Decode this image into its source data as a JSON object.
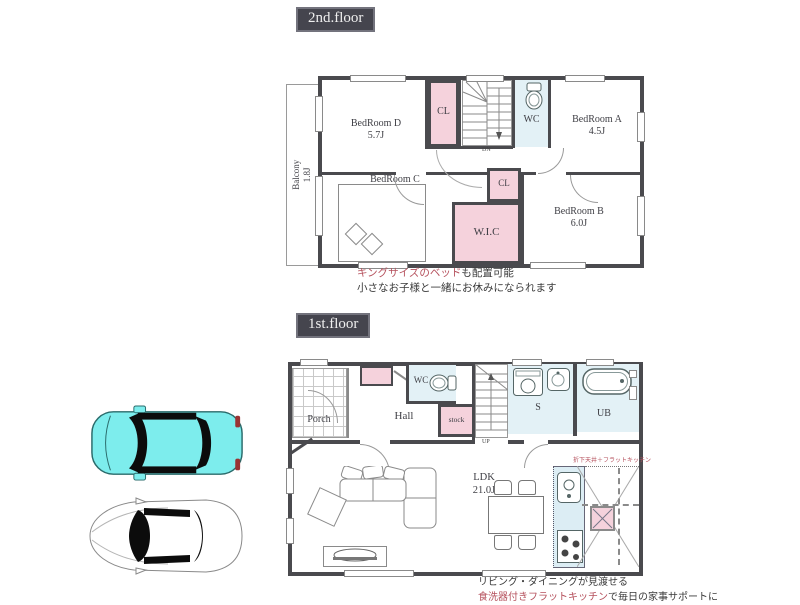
{
  "palette": {
    "wall": "#4a4a4e",
    "closet_pink": "#f5d2dc",
    "wet_area_blue": "#e3f1f6",
    "tag_background": "#45454e",
    "accent_red": "#b5505c",
    "car_cyan": "#7deded"
  },
  "floor2": {
    "tag": "2nd.floor",
    "balcony": {
      "name": "Balcony",
      "size": "1.8J"
    },
    "bedroomD": {
      "name": "BedRoom D",
      "size": "5.7J"
    },
    "cl_top": {
      "name": "CL"
    },
    "wc": {
      "name": "WC"
    },
    "bedroomA": {
      "name": "BedRoom A",
      "size": "4.5J"
    },
    "bedroomC": {
      "name": "BedRoom C",
      "size": "7.2J"
    },
    "cl_mid": {
      "name": "CL"
    },
    "wic": {
      "name": "W.I.C"
    },
    "bedroomB": {
      "name": "BedRoom B",
      "size": "6.0J"
    },
    "stairs_label": "DN",
    "caption_highlight": "キングサイズのベッド",
    "caption_rest": "も配置可能",
    "caption_line2": "小さなお子様と一緒にお休みになられます"
  },
  "floor1": {
    "tag": "1st.floor",
    "porch": {
      "name": "Porch"
    },
    "hall": {
      "name": "Hall"
    },
    "wc": {
      "name": "WC"
    },
    "stock": {
      "name": "stock"
    },
    "sanitary": {
      "name": "S"
    },
    "bath": {
      "name": "UB"
    },
    "ldk": {
      "name": "LDK",
      "size": "21.0J"
    },
    "stairs_label": "UP",
    "kitchen_note": "折下天井＋フラットキッチン",
    "caption_line1": "リビング・ダイニングが見渡せる",
    "caption_highlight": "食洗器付きフラットキッチン",
    "caption_rest": "で毎日の家事サポートに"
  }
}
